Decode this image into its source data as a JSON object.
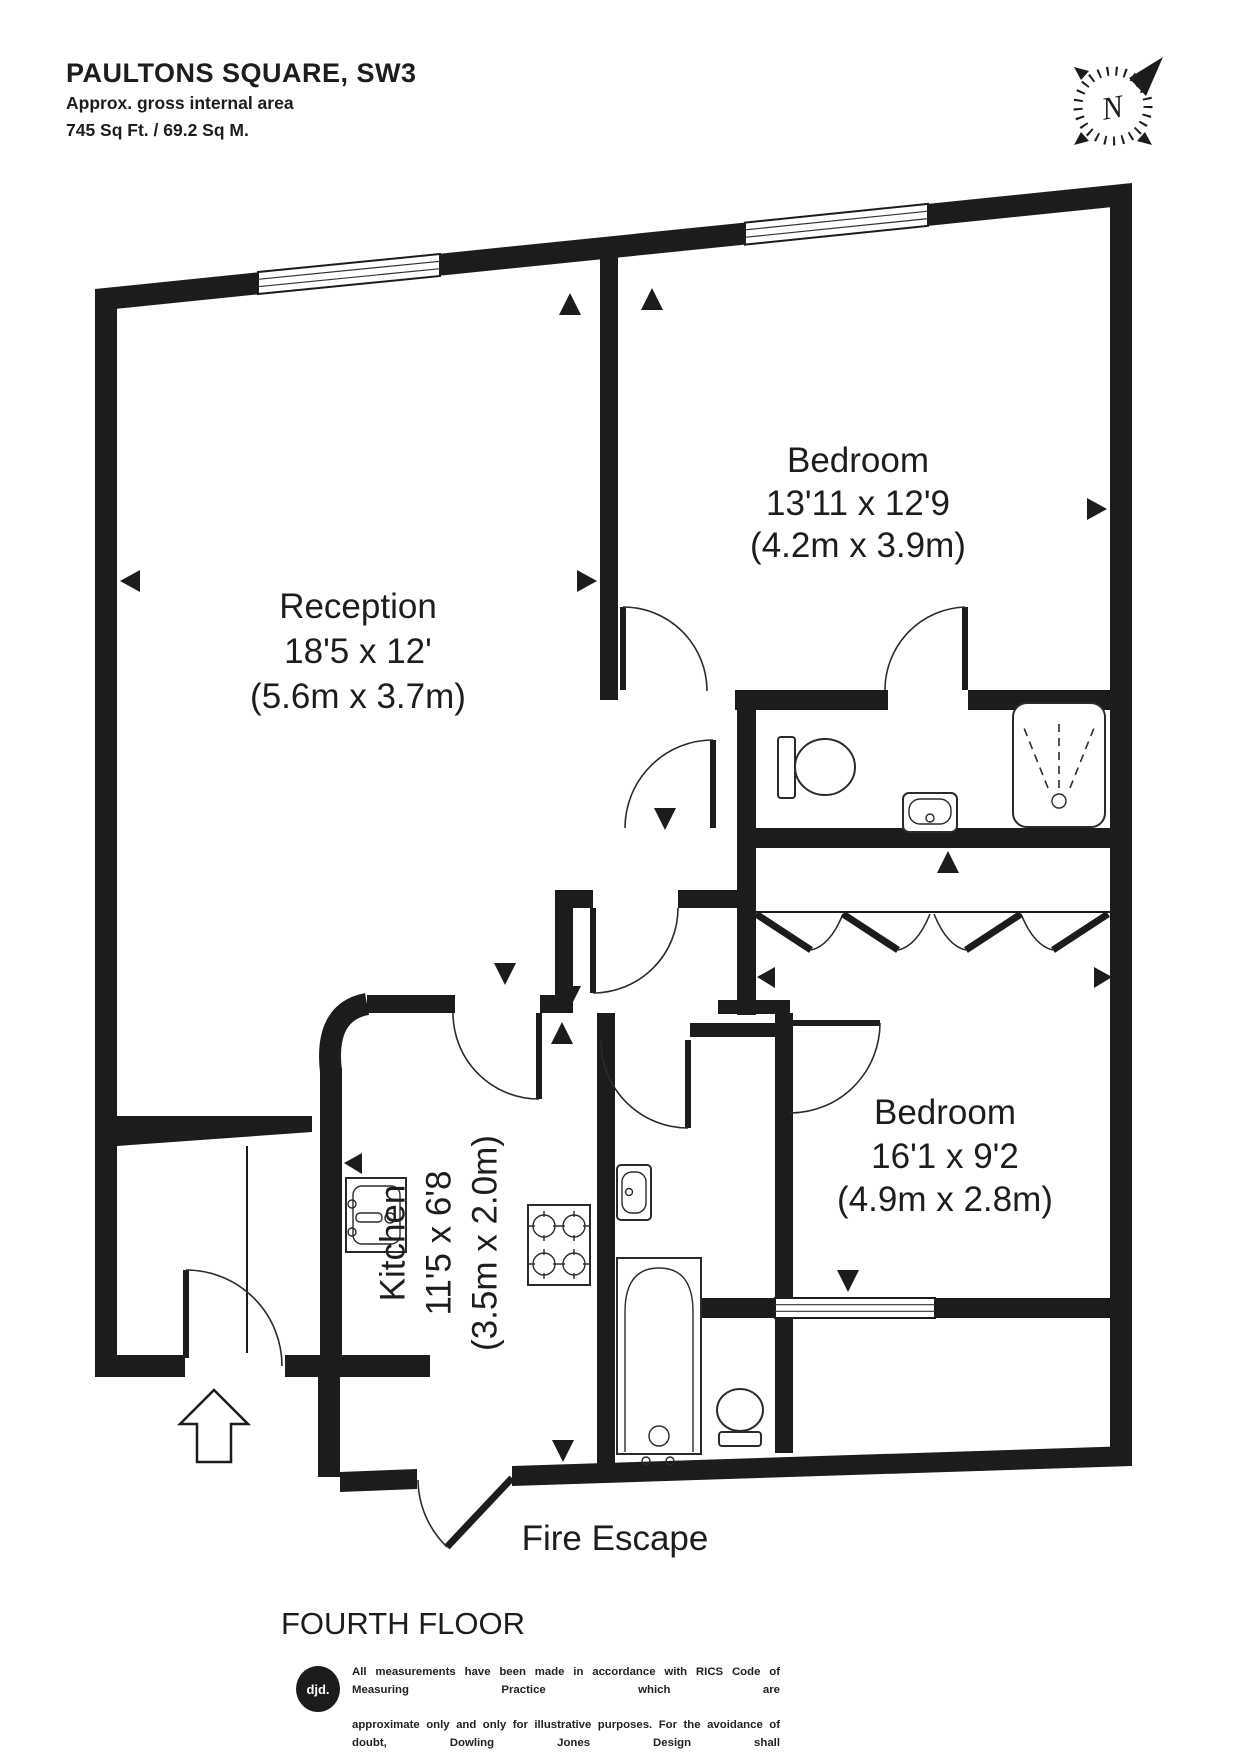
{
  "header": {
    "title": "PAULTONS SQUARE, SW3",
    "subtitle": "Approx. gross internal area",
    "area": "745 Sq Ft. / 69.2 Sq M."
  },
  "compass": {
    "north": "N"
  },
  "plan": {
    "reception": {
      "name": "Reception",
      "imperial": "18'5 x 12'",
      "metric": "(5.6m x 3.7m)"
    },
    "bedroom1": {
      "name": "Bedroom",
      "imperial": "13'11 x 12'9",
      "metric": "(4.2m x 3.9m)"
    },
    "bedroom2": {
      "name": "Bedroom",
      "imperial": "16'1 x 9'2",
      "metric": "(4.9m x 2.8m)"
    },
    "kitchen": {
      "name": "Kitchen",
      "imperial": "11'5 x 6'8",
      "metric": "(3.5m x 2.0m)"
    },
    "fire_escape": "Fire Escape",
    "floor": "FOURTH FLOOR"
  },
  "footer": {
    "logo": "djd.",
    "disclaimer_line1": "All measurements have been made in accordance with RICS Code of Measuring Practice which are",
    "disclaimer_line2": "approximate only and only for illustrative purposes. For the avoidance of doubt, Dowling Jones Design shall",
    "disclaimer_line3": "not be liable for any reliance on these measurements. © 2016 www.dowlingjones.com 020 7610 9933"
  },
  "colors": {
    "wall": "#1c1c1c",
    "paper": "#ffffff"
  }
}
